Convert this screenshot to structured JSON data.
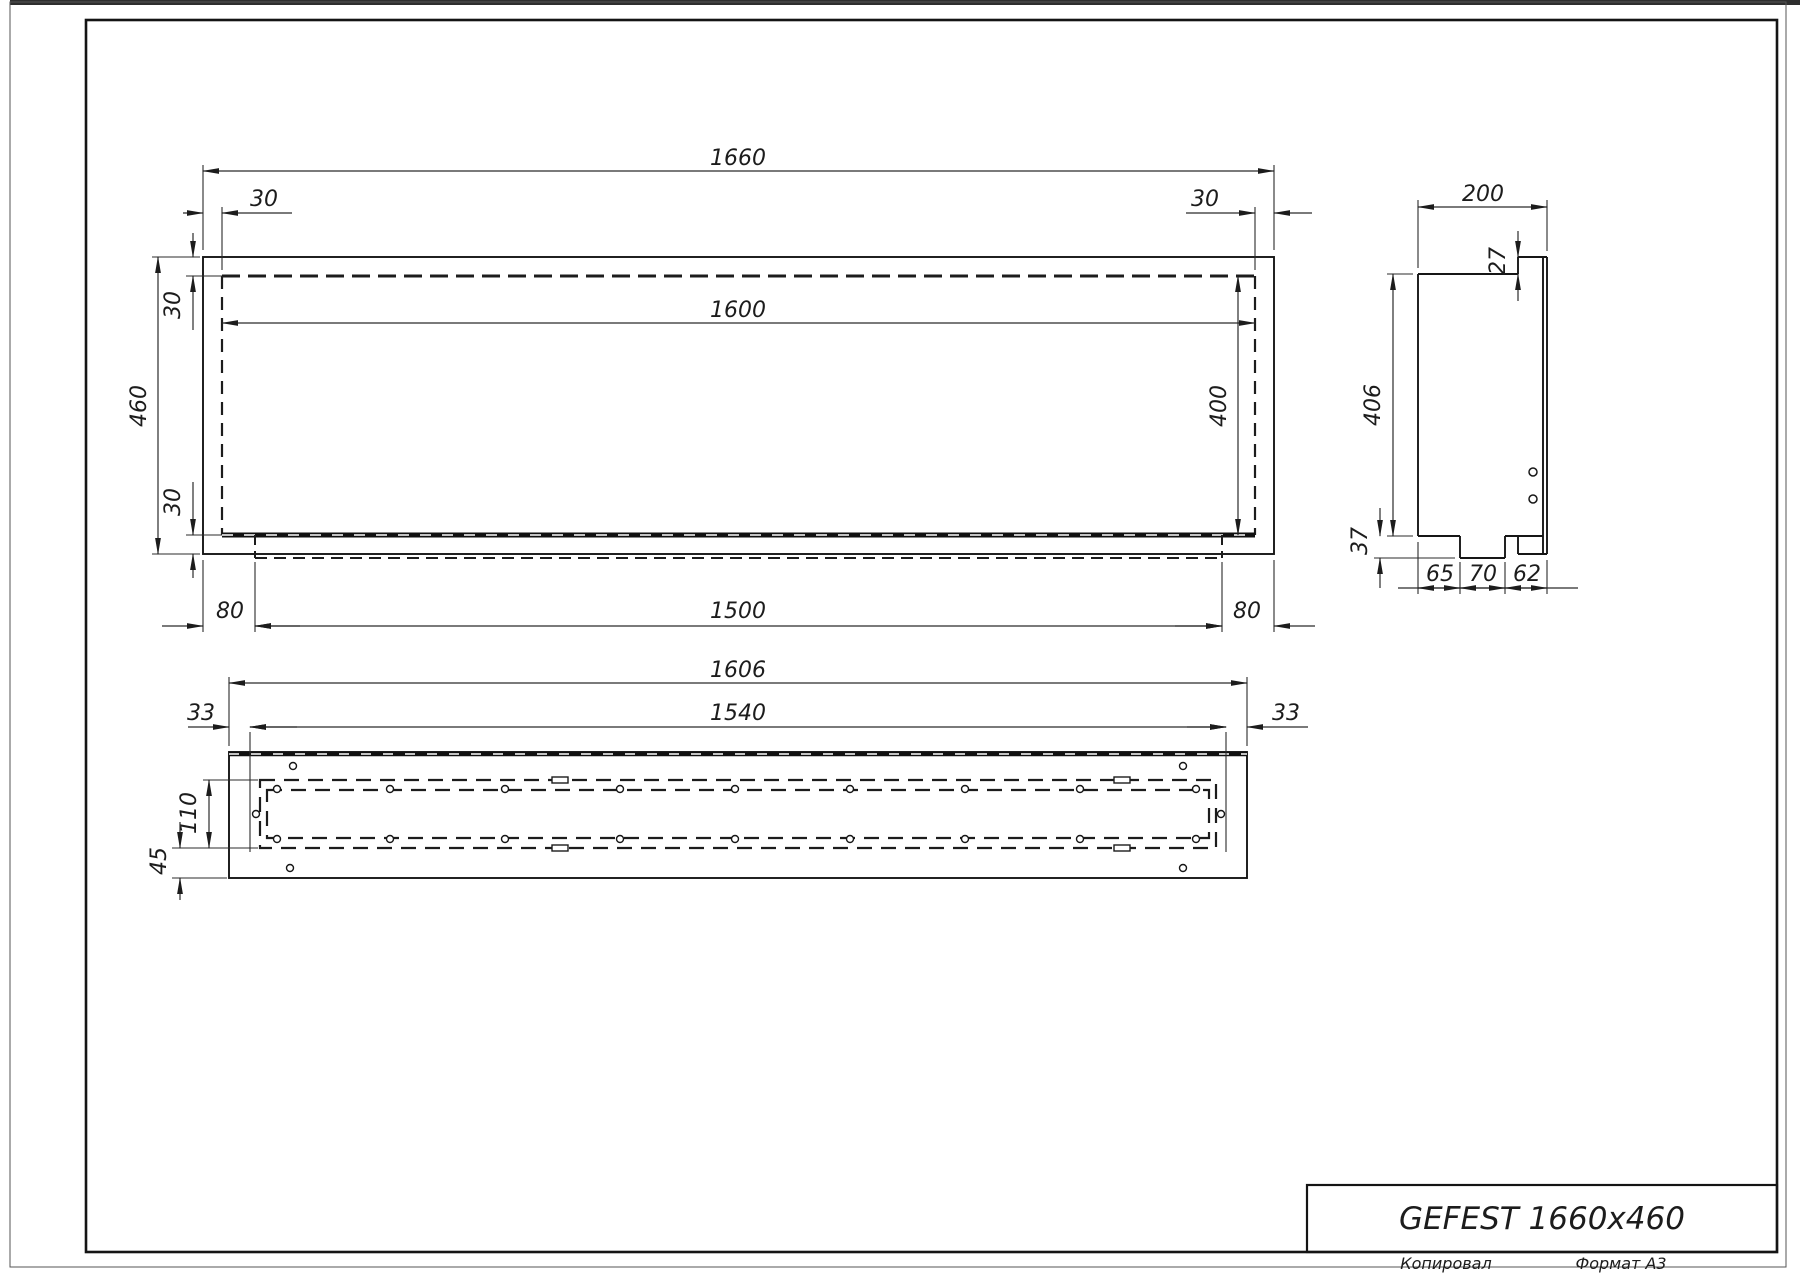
{
  "title_block": {
    "model": "GEFEST 1660x460"
  },
  "footer": {
    "copied_by": "Копировал",
    "format": "Формат A3"
  },
  "front_view": {
    "overall_width": "1660",
    "overall_height": "460",
    "inner_width": "1600",
    "inner_height": "400",
    "inset_left": "30",
    "inset_right": "30",
    "inset_top": "30",
    "inset_bottom": "30",
    "tray_margin_left": "80",
    "tray_length": "1500",
    "tray_margin_right": "80"
  },
  "side_view": {
    "depth": "200",
    "flange_lip": "27",
    "body_height": "406",
    "tray_drop": "37",
    "segments": [
      "65",
      "70",
      "62"
    ]
  },
  "bottom_view": {
    "overall_width": "1606",
    "margin_left": "33",
    "slot_span": "1540",
    "margin_right": "33",
    "slot_width": "110",
    "bottom_margin": "45"
  }
}
